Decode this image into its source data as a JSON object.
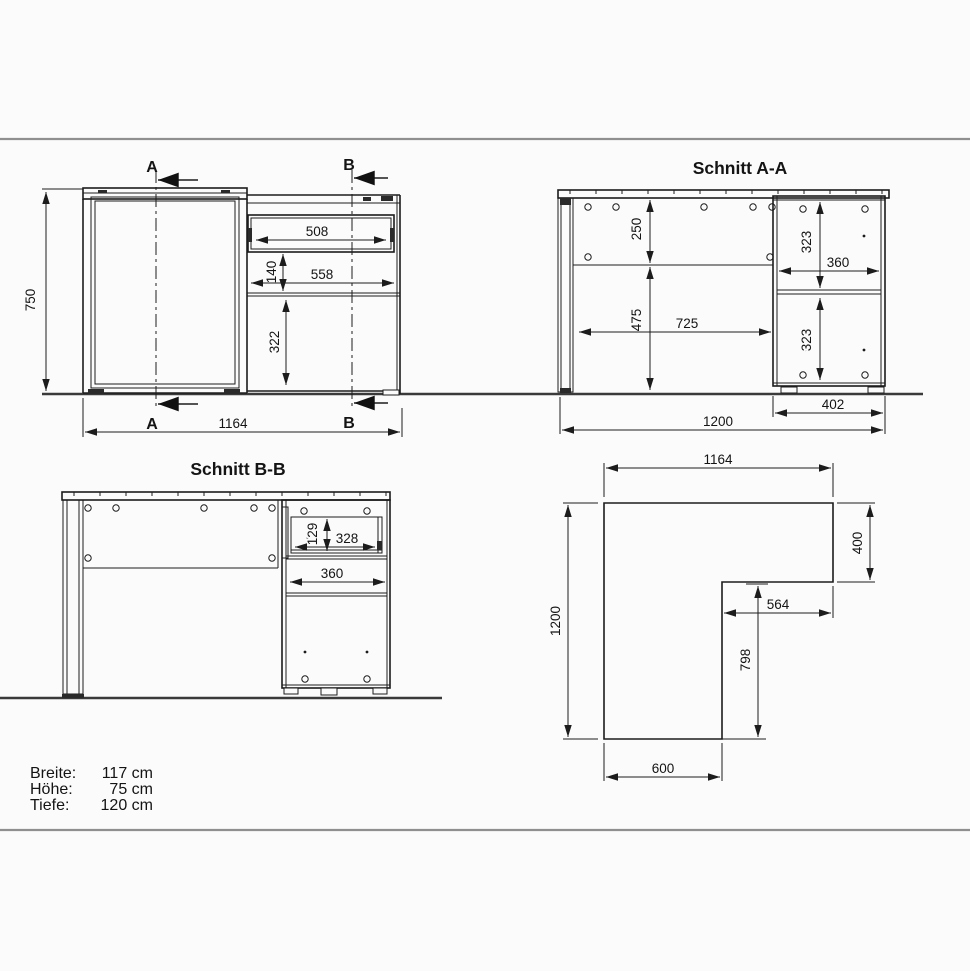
{
  "front_view": {
    "section_a_label": "A",
    "section_b_label": "B",
    "dim_height": "750",
    "dim_width": "1164",
    "dim_drawer_width": "508",
    "dim_open_width": "558",
    "dim_drawer_height": "140",
    "dim_compartment_height": "322"
  },
  "section_aa": {
    "title": "Schnitt A-A",
    "dim_back_height": "250",
    "dim_under_height": "475",
    "dim_knee_depth": "725",
    "dim_upper_box": "323",
    "dim_shelf_depth": "360",
    "dim_lower_box": "323",
    "dim_pedestal_depth": "402",
    "dim_total_depth": "1200"
  },
  "section_bb": {
    "title": "Schnitt B-B",
    "dim_drawer_inner_height": "129",
    "dim_drawer_inner_depth": "328",
    "dim_pedestal_inner_width": "360"
  },
  "top_view": {
    "dim_width": "1164",
    "dim_return_depth": "400",
    "dim_return_clear": "564",
    "dim_side_clear": "798",
    "dim_total_depth": "1200",
    "dim_main_width": "600"
  },
  "specs": {
    "rows": [
      {
        "label": "Breite:",
        "value": "117 cm"
      },
      {
        "label": "Höhe:",
        "value": "75 cm"
      },
      {
        "label": "Tiefe:",
        "value": "120 cm"
      }
    ]
  }
}
